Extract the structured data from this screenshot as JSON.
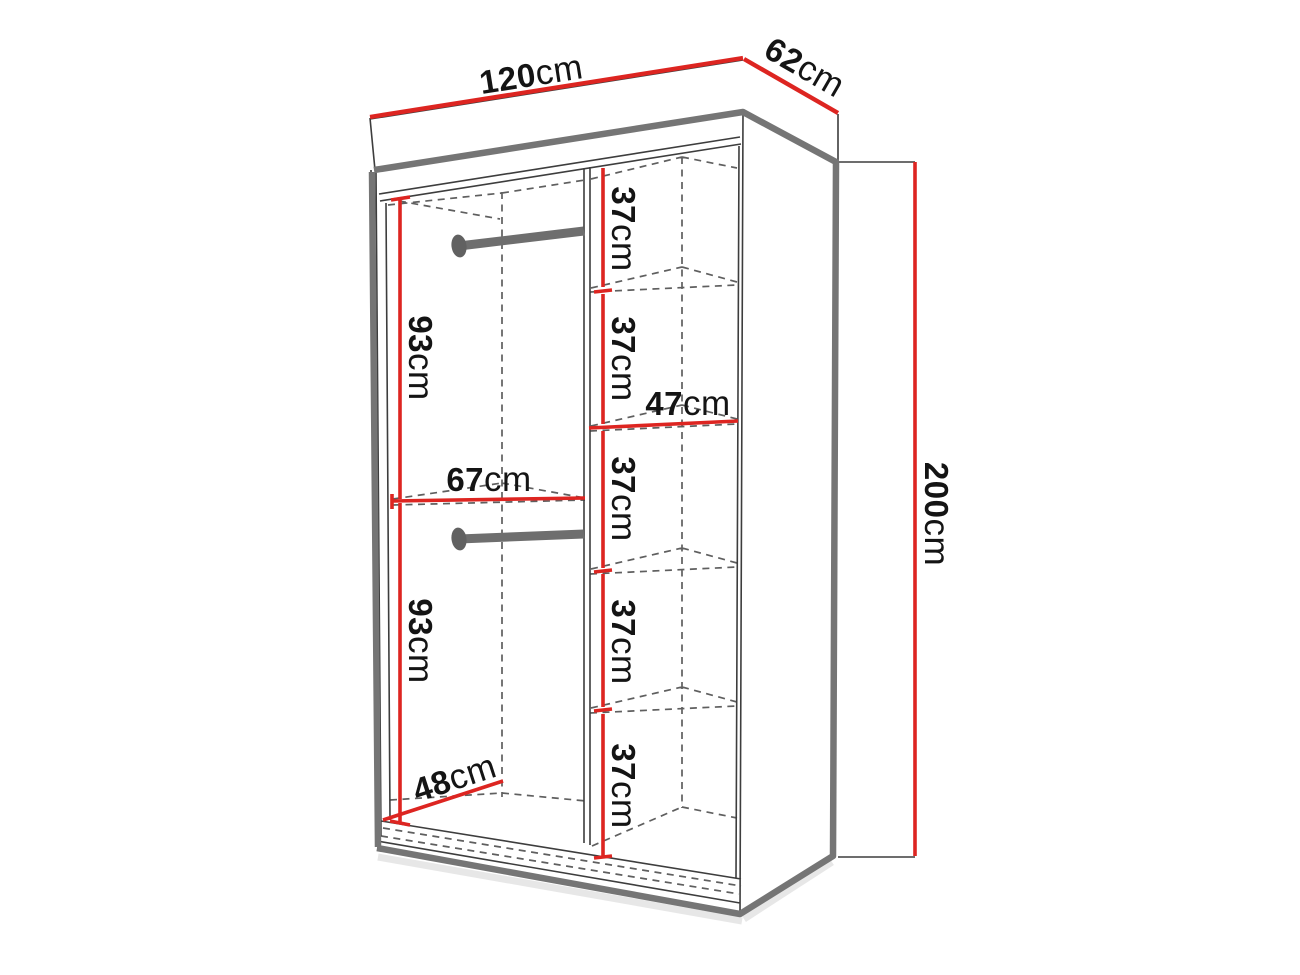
{
  "diagram_type": "wardrobe-dimension-diagram",
  "colors": {
    "dimension_red": "#dd2521",
    "edge_gray": "#757575",
    "line_dark": "#3d3d3d",
    "text": "#141414",
    "background": "#ffffff"
  },
  "dimensions": {
    "overall_width": {
      "value": "120",
      "unit": "cm"
    },
    "overall_depth": {
      "value": "62",
      "unit": "cm"
    },
    "overall_height": {
      "value": "200",
      "unit": "cm"
    },
    "top_section_height": {
      "value": "93",
      "unit": "cm"
    },
    "bottom_section_height": {
      "value": "93",
      "unit": "cm"
    },
    "hanging_width": {
      "value": "67",
      "unit": "cm"
    },
    "interior_depth": {
      "value": "48",
      "unit": "cm"
    },
    "shelf_width": {
      "value": "47",
      "unit": "cm"
    },
    "shelf_heights": [
      {
        "value": "37",
        "unit": "cm"
      },
      {
        "value": "37",
        "unit": "cm"
      },
      {
        "value": "37",
        "unit": "cm"
      },
      {
        "value": "37",
        "unit": "cm"
      },
      {
        "value": "37",
        "unit": "cm"
      }
    ]
  }
}
